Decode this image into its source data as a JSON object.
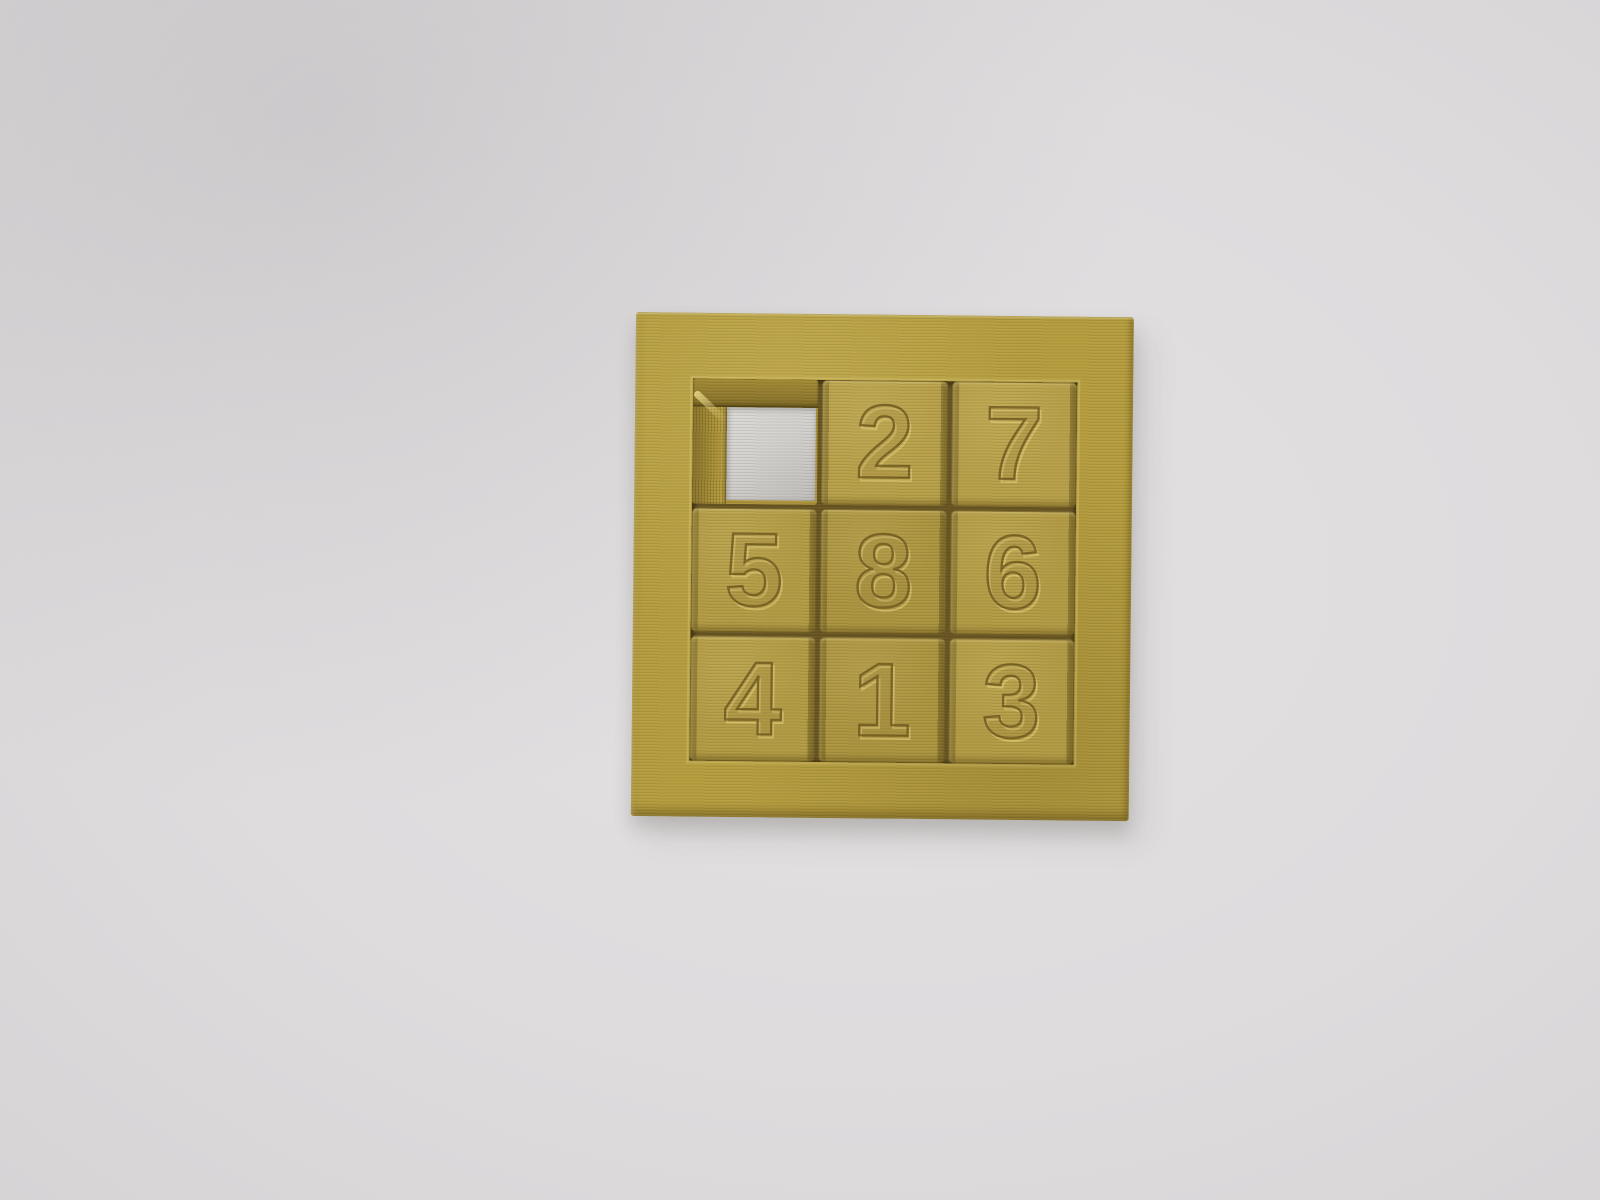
{
  "scene": {
    "description": "Photograph of a gold 3D-printed 3x3 sliding number puzzle lying on a plain light-gray surface",
    "object": "slide-puzzle"
  },
  "puzzle": {
    "grid_rows": 3,
    "grid_cols": 3,
    "layout_rows": [
      [
        "",
        "2",
        "7"
      ],
      [
        "5",
        "8",
        "6"
      ],
      [
        "4",
        "1",
        "3"
      ]
    ],
    "empty_position": "row1-col1",
    "tiles": [
      {
        "position": "row1-col1",
        "label": "",
        "empty": true
      },
      {
        "position": "row1-col2",
        "label": "2"
      },
      {
        "position": "row1-col3",
        "label": "7"
      },
      {
        "position": "row2-col1",
        "label": "5"
      },
      {
        "position": "row2-col2",
        "label": "8"
      },
      {
        "position": "row2-col3",
        "label": "6"
      },
      {
        "position": "row3-col1",
        "label": "4"
      },
      {
        "position": "row3-col2",
        "label": "1"
      },
      {
        "position": "row3-col3",
        "label": "3"
      }
    ]
  },
  "colors": {
    "background_gray": "#dedcdd",
    "frame_gold": "#b59d3f",
    "tile_gold": "#b19a44",
    "tray_gap_dark": "#665322",
    "engraving_dark": "#70591d",
    "engraving_highlight": "#ecd886",
    "hole_white": "#d3d1d0"
  }
}
